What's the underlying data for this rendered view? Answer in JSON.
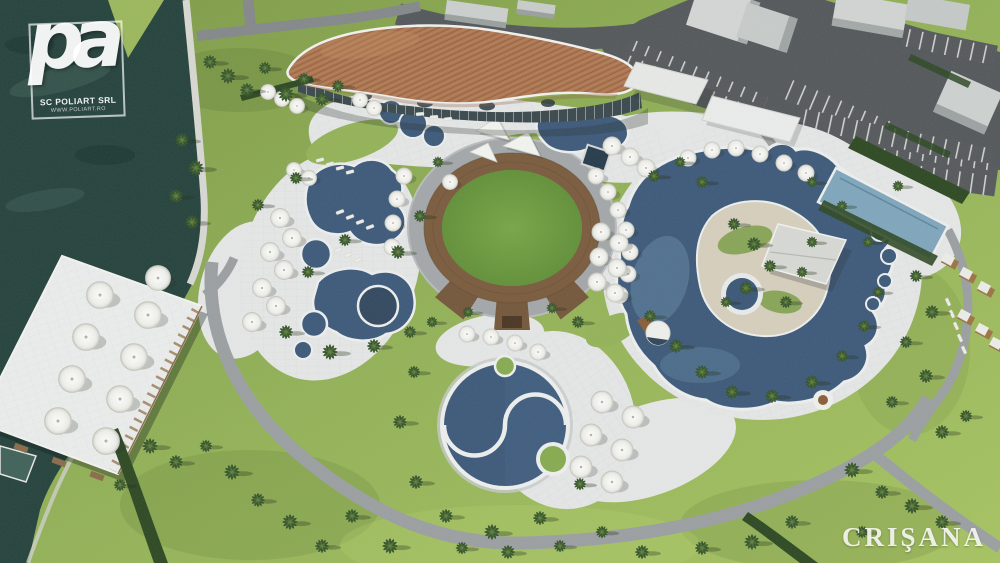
{
  "watermarks": {
    "logo_letters": "pa",
    "logo_company": "SC POLIART SRL",
    "logo_website": "WWW.POLIART.RO",
    "publisher": "CRIŞANA"
  },
  "colors": {
    "water": "#24413c",
    "lawn": "#93b257",
    "asphalt": "#53575b",
    "path": "#9b9fa2",
    "plaza": "#e7e8e9",
    "pool": "#3c587a",
    "lap_pool": "#7fa6bd",
    "roof": "#ad7450",
    "ring_wood": "#7a5a3d",
    "amphitheater_lawn": "#6f9e41",
    "hedge": "#2c4722",
    "sand": "#d7cfbe",
    "tent": "#d8d9d6"
  }
}
